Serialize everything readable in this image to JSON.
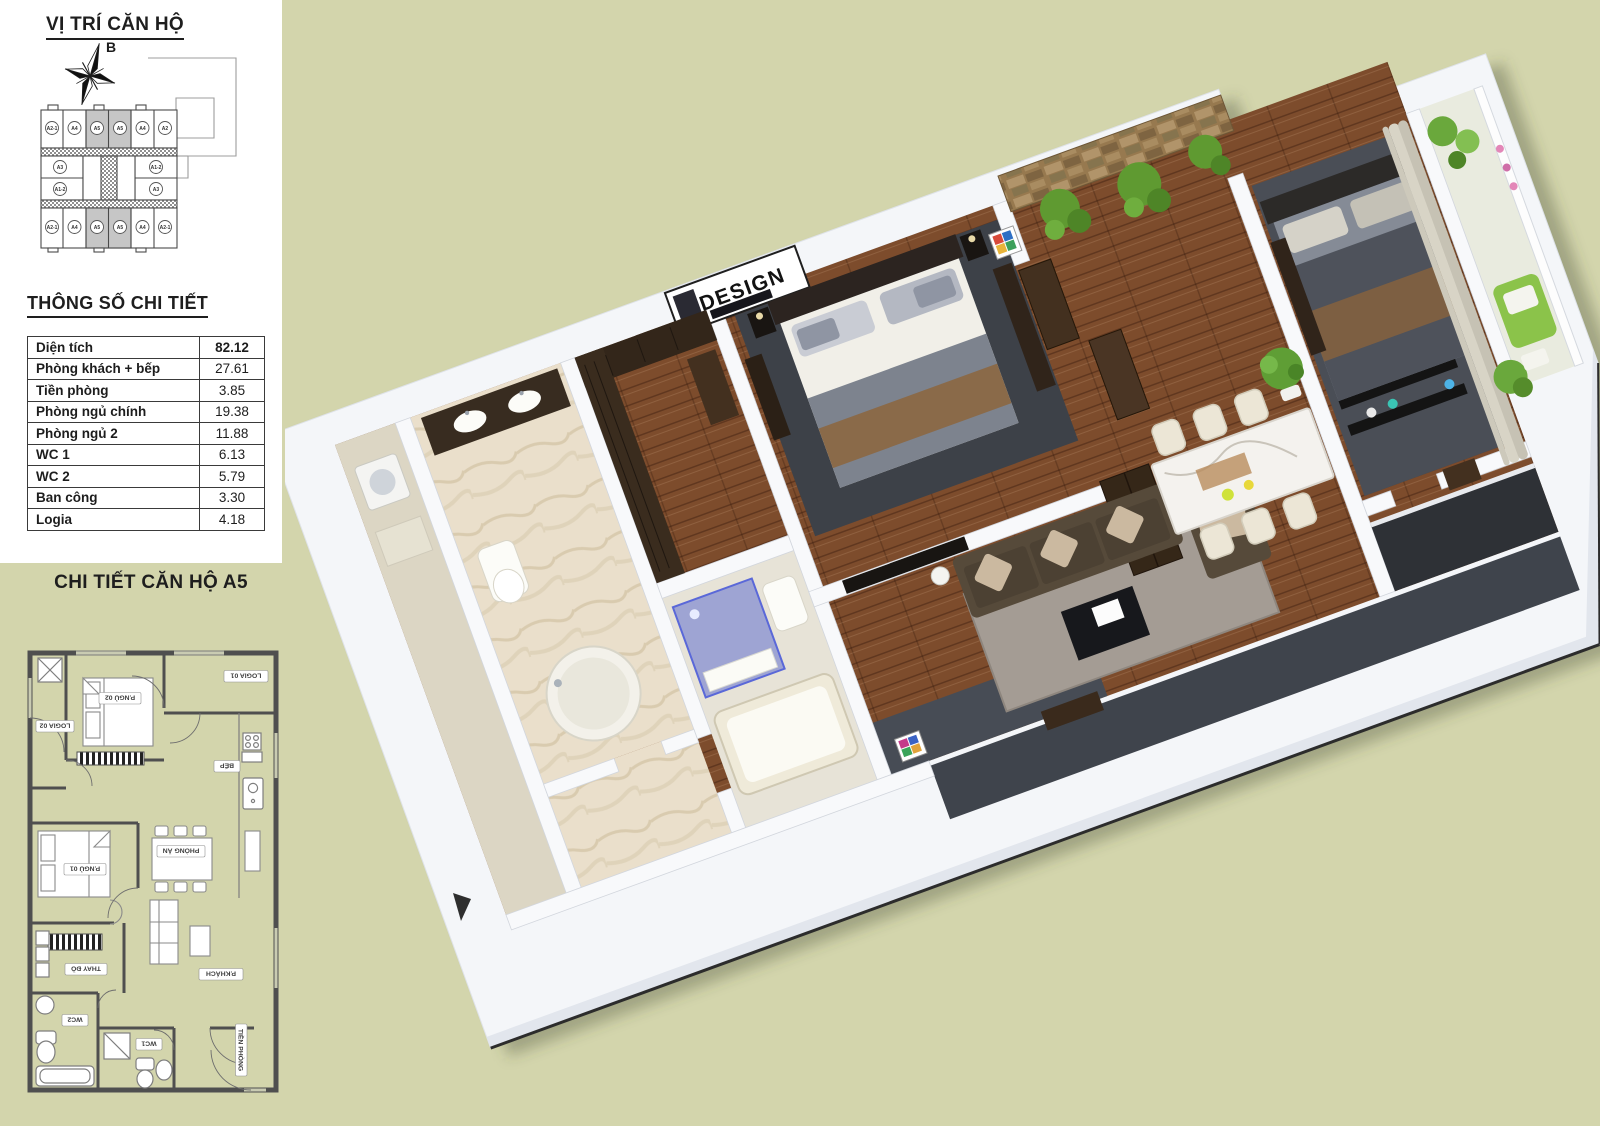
{
  "colors": {
    "background": "#d3d5ac",
    "keyplan_highlight": "#c6c6c6"
  },
  "sidebar": {
    "location_title": "VỊ TRÍ CĂN HỘ",
    "compass_label": "B",
    "keyplan": {
      "top_units": [
        "A2-1",
        "A4",
        "A5",
        "A5",
        "A4",
        "A2"
      ],
      "middle_left_units": [
        "A3",
        "A1-2"
      ],
      "middle_right_units": [
        "A1-2",
        "A3"
      ],
      "bottom_units": [
        "A2-1",
        "A4",
        "A5",
        "A5",
        "A4",
        "A2-1"
      ],
      "highlight_unit": "A5"
    },
    "specs": {
      "title": "THÔNG SỐ CHI TIẾT",
      "rows": [
        {
          "label": "Diện tích",
          "value": "82.12"
        },
        {
          "label": "Phòng khách + bếp",
          "value": "27.61"
        },
        {
          "label": "Tiền phòng",
          "value": "3.85"
        },
        {
          "label": "Phòng ngủ chính",
          "value": "19.38"
        },
        {
          "label": "Phòng ngủ 2",
          "value": "11.88"
        },
        {
          "label": "WC 1",
          "value": "6.13"
        },
        {
          "label": "WC 2",
          "value": "5.79"
        },
        {
          "label": "Ban công",
          "value": "3.30"
        },
        {
          "label": "Logia",
          "value": "4.18"
        }
      ]
    }
  },
  "detail": {
    "title": "CHI TIẾT CĂN HỘ A5",
    "plan_labels": {
      "logia01": "LOGIA 01",
      "logia02": "LOGIA 02",
      "bedroom2": "P.NGỦ 02",
      "bedroom1": "P.NGỦ 01",
      "kitchen": "BẾP",
      "dining": "PHÒNG ĂN",
      "living": "P.KHÁCH",
      "dressing": "THAY ĐỒ",
      "wc1": "WC1",
      "wc2": "WC2",
      "hall": "TIỀN PHÒNG"
    }
  },
  "render3d": {
    "artwork_text": "DESIGN"
  }
}
